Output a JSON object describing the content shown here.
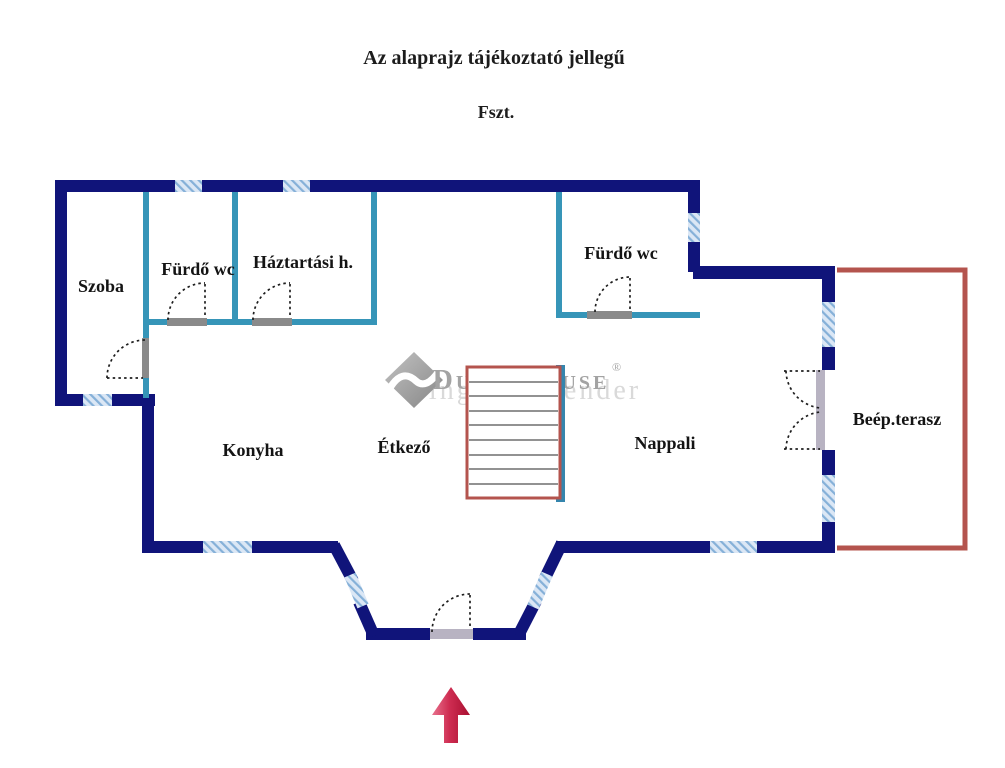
{
  "header": {
    "disclaimer": "Az alaprajz tájékoztató jellegű",
    "floor_label": "Fszt."
  },
  "rooms": {
    "szoba": "Szoba",
    "furdo_wc_left": "Fürdő wc",
    "haztartasi": "Háztartási h.",
    "furdo_wc_right": "Fürdő wc",
    "konyha": "Konyha",
    "etkezo": "Étkező",
    "nappali": "Nappali",
    "terasz": "Beép.terasz"
  },
  "watermark": {
    "brand": "Duna House",
    "registered": "®",
    "subtext": "ingatlan tender"
  },
  "icons": {
    "entrance_arrow": "up-arrow-entrance-marker",
    "logo_diamond": "duna-house-diamond-logo"
  },
  "colors": {
    "exterior_wall": "#10147a",
    "interior_wall": "#3695b8",
    "stair_wall": "#3585ad",
    "window_fill": "#dbe7f5",
    "window_stripe": "#85b0d8",
    "terrace_wall": "#b4544e",
    "stairs_outline": "#b4544e",
    "stair_step_line": "#6f6f6f",
    "door_threshold": "#8a8a8a",
    "wide_threshold": "#b8b3c2",
    "entrance_arrow": "#c01f44",
    "watermark_gray": "#a3a3a3"
  }
}
